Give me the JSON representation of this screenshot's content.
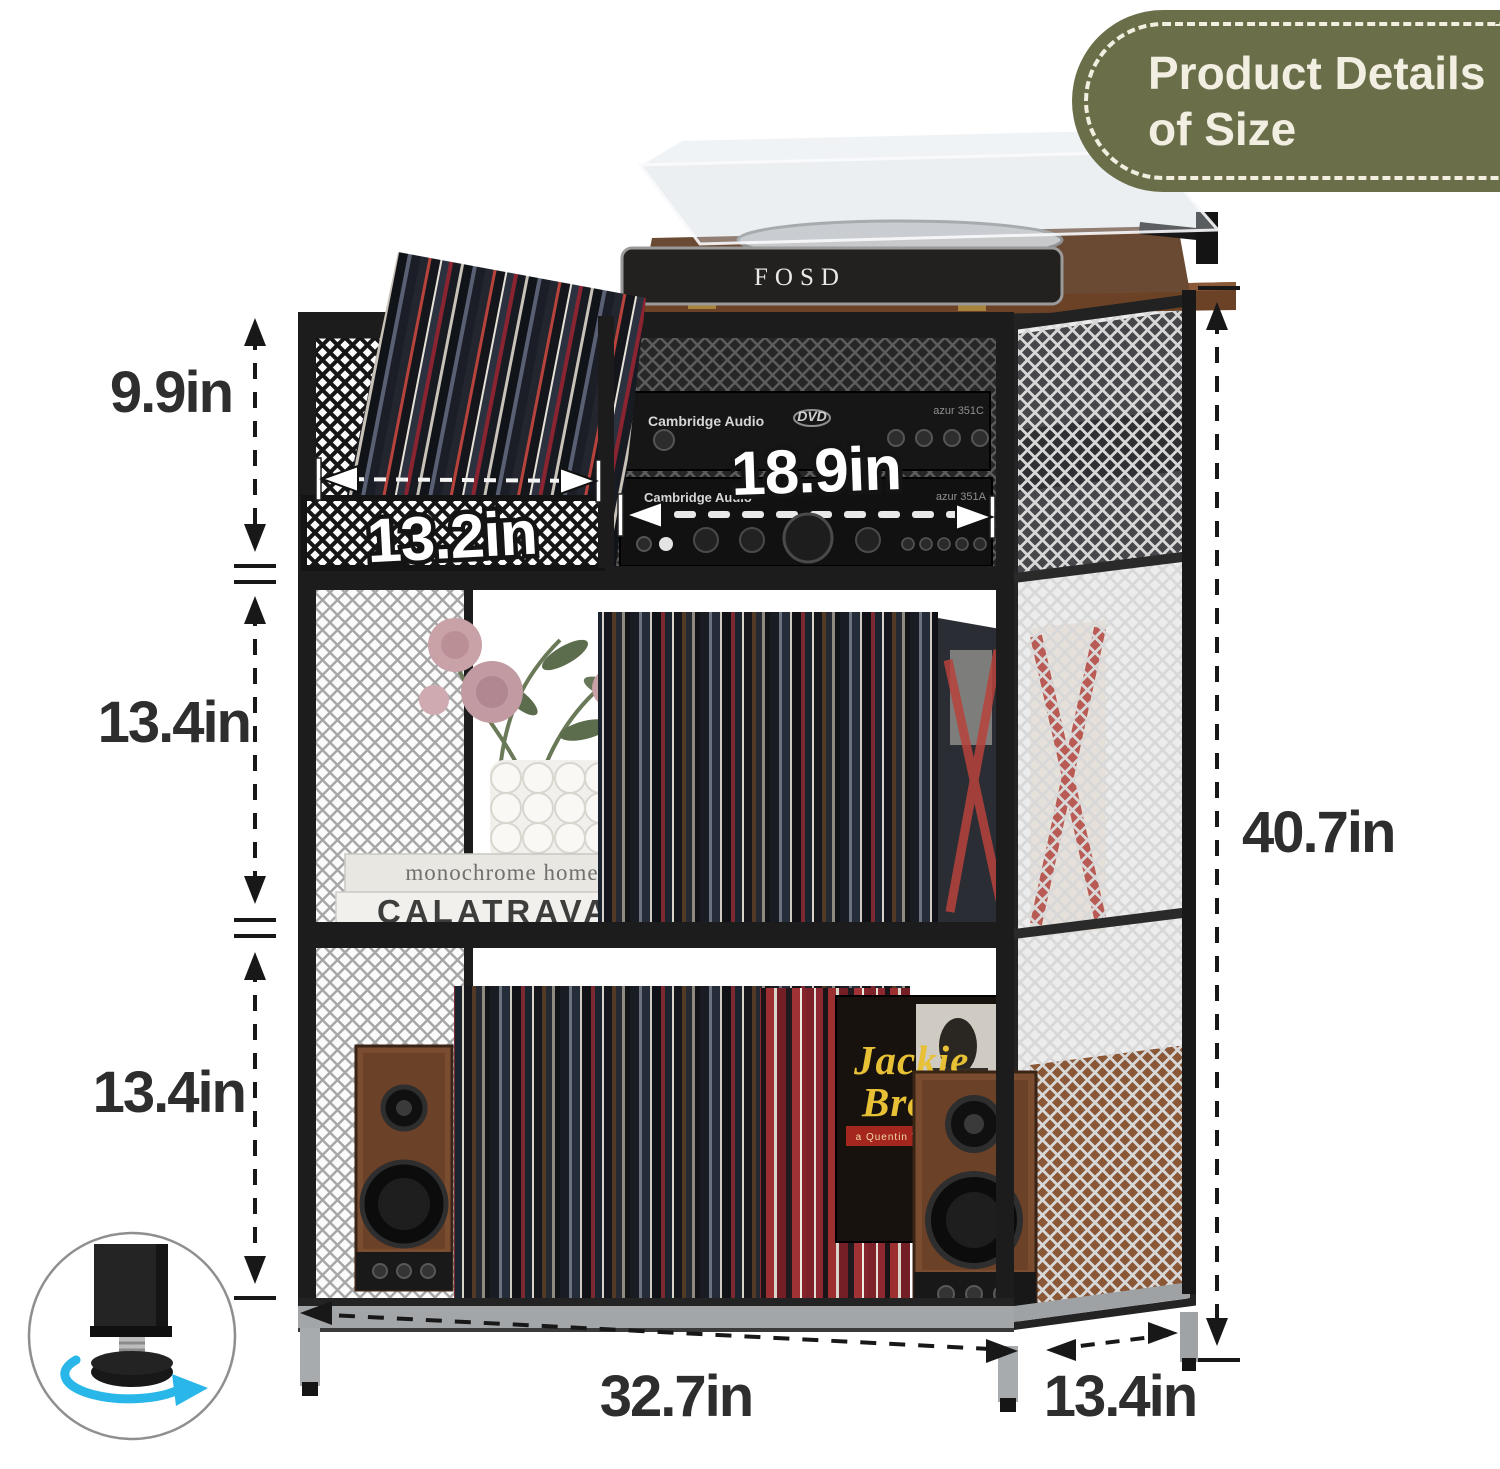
{
  "badge": {
    "line1": "Product Details",
    "line2": "of Size"
  },
  "dims": {
    "top_height": "9.9in",
    "left_cubby_width": "13.2in",
    "middle_cubby_width": "18.9in",
    "middle_height": "13.4in",
    "bottom_height": "13.4in",
    "total_height": "40.7in",
    "total_width": "32.7in",
    "depth": "13.4in"
  },
  "labels": {
    "turntable_brand": "FOSD",
    "cd_brand": "Cambridge Audio",
    "amp_brand": "Cambridge Audio",
    "cd_model": "azur 351C",
    "amp_model": "azur 351A",
    "dvd_logo": "DVD",
    "book_top": "monochrome home",
    "book_bottom": "CALATRAVA",
    "book_publisher": "TASCHEN",
    "record_title_line1": "Jackie",
    "record_title_line2": "Brown",
    "record_banner": "a Quentin Tarantino Film"
  },
  "colors": {
    "badge_bg": "#6a6e49",
    "badge_text": "#f2efe2",
    "dimension_text": "#2e2e2e",
    "accent_cyan": "#29b6e8",
    "wood_top": "#6b4226",
    "walnut": "#7a4c30",
    "frame_black": "#1c1c1c"
  }
}
